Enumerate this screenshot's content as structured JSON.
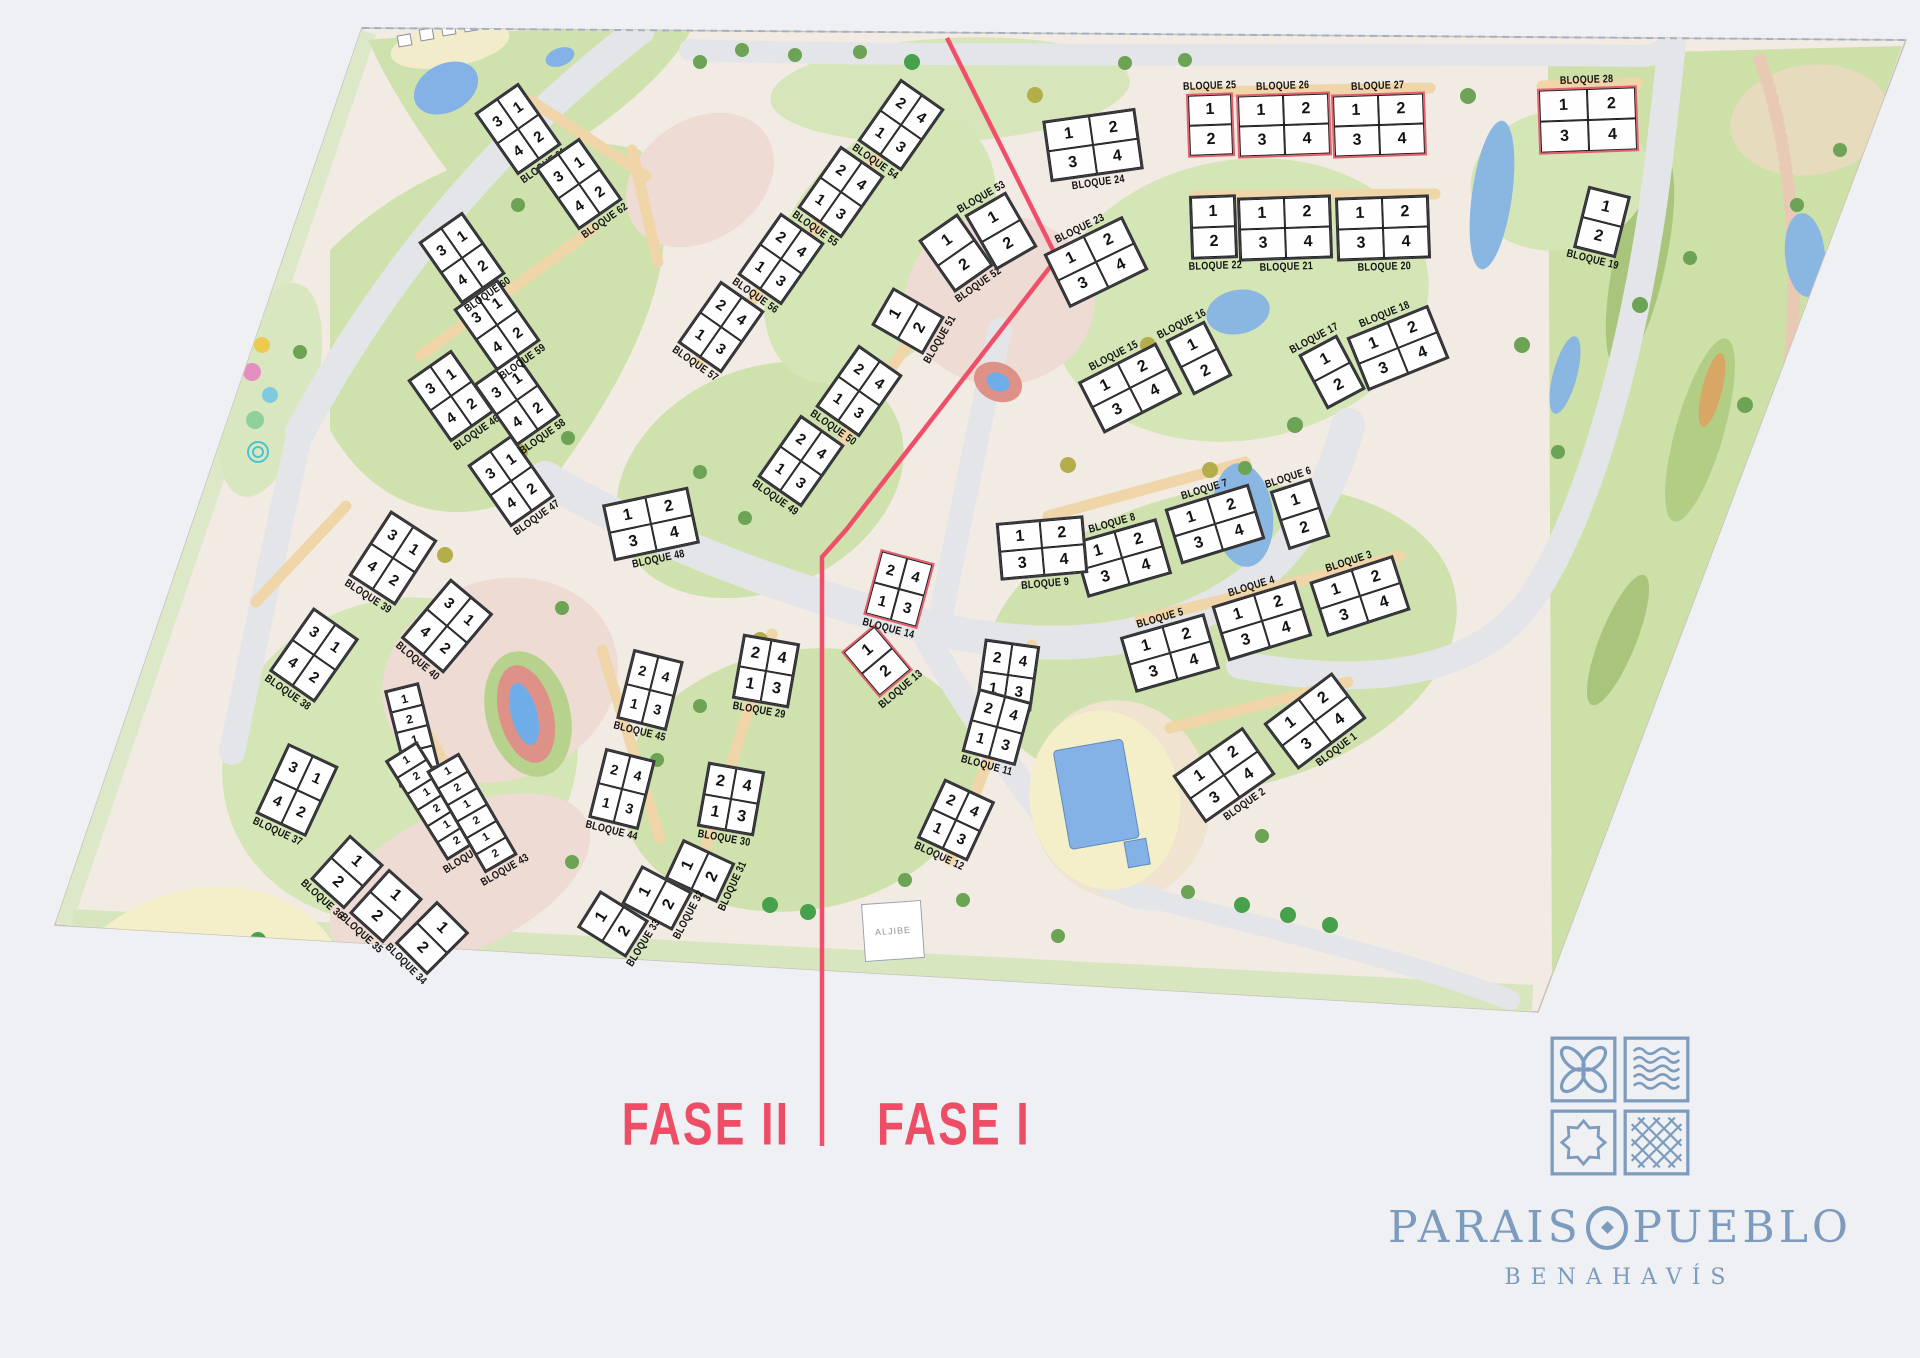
{
  "map": {
    "fase1_label": "FASE I",
    "fase2_label": "FASE II",
    "aljibe_label": "ALJIBE",
    "fase_line_points": "947,38 1057,258 846,530 822,557 822,1146",
    "colors": {
      "accent_red": "#ee4d66",
      "logo_blue": "#7d9cbd",
      "pool_blue": "#84b2e6",
      "lawn_green": "#cfe2ad",
      "road_gray": "#e4e5e9",
      "land_pink": "#f2ebe4",
      "block_white": "#fefefe"
    },
    "blocks": [
      {
        "id": 1,
        "label": "BLOQUE 1",
        "x": 1315,
        "y": 721,
        "w": 86,
        "h": 58,
        "a": -37,
        "cells": [
          [
            1,
            2
          ],
          [
            3,
            4
          ]
        ]
      },
      {
        "id": 2,
        "label": "BLOQUE 2",
        "x": 1224,
        "y": 775,
        "w": 86,
        "h": 58,
        "a": -35,
        "cells": [
          [
            1,
            2
          ],
          [
            3,
            4
          ]
        ]
      },
      {
        "id": 3,
        "label": "BLOQUE 3",
        "x": 1360,
        "y": 596,
        "w": 88,
        "h": 58,
        "a": -18,
        "cells": [
          [
            1,
            2
          ],
          [
            3,
            4
          ]
        ],
        "lp": "t"
      },
      {
        "id": 4,
        "label": "BLOQUE 4",
        "x": 1262,
        "y": 621,
        "w": 88,
        "h": 58,
        "a": -17,
        "cells": [
          [
            1,
            2
          ],
          [
            3,
            4
          ]
        ],
        "lp": "t"
      },
      {
        "id": 5,
        "label": "BLOQUE 5",
        "x": 1170,
        "y": 653,
        "w": 88,
        "h": 58,
        "a": -16,
        "cells": [
          [
            1,
            2
          ],
          [
            3,
            4
          ]
        ],
        "lp": "t"
      },
      {
        "id": 6,
        "label": "BLOQUE 6",
        "x": 1300,
        "y": 514,
        "w": 44,
        "h": 62,
        "a": -18,
        "cells": [
          [
            1
          ],
          [
            2
          ]
        ],
        "lp": "t"
      },
      {
        "id": 7,
        "label": "BLOQUE 7",
        "x": 1215,
        "y": 524,
        "w": 88,
        "h": 58,
        "a": -17,
        "cells": [
          [
            1,
            2
          ],
          [
            3,
            4
          ]
        ],
        "lp": "t"
      },
      {
        "id": 8,
        "label": "BLOQUE 8",
        "x": 1122,
        "y": 558,
        "w": 88,
        "h": 58,
        "a": -16,
        "cells": [
          [
            1,
            2
          ],
          [
            3,
            4
          ]
        ],
        "lp": "t"
      },
      {
        "id": 9,
        "label": "BLOQUE 9",
        "x": 1042,
        "y": 548,
        "w": 88,
        "h": 58,
        "a": -5,
        "cells": [
          [
            1,
            2
          ],
          [
            3,
            4
          ]
        ]
      },
      {
        "id": 10,
        "label": "BLOQUE 10",
        "x": 1008,
        "y": 675,
        "w": 56,
        "h": 66,
        "a": 8,
        "cells": [
          [
            2,
            4
          ],
          [
            1,
            3
          ]
        ]
      },
      {
        "id": 11,
        "label": "BLOQUE 11",
        "x": 997,
        "y": 727,
        "w": 56,
        "h": 66,
        "a": 15,
        "cells": [
          [
            2,
            4
          ],
          [
            1,
            3
          ]
        ]
      },
      {
        "id": 12,
        "label": "BLOQUE 12",
        "x": 956,
        "y": 820,
        "w": 56,
        "h": 66,
        "a": 25,
        "cells": [
          [
            2,
            4
          ],
          [
            1,
            3
          ]
        ]
      },
      {
        "id": 13,
        "label": "BLOQUE 13",
        "x": 877,
        "y": 661,
        "w": 44,
        "h": 60,
        "a": -40,
        "cells": [
          [
            1
          ],
          [
            2
          ]
        ],
        "hl": true
      },
      {
        "id": 14,
        "label": "BLOQUE 14",
        "x": 899,
        "y": 589,
        "w": 56,
        "h": 68,
        "a": 15,
        "cells": [
          [
            2,
            4
          ],
          [
            1,
            3
          ]
        ],
        "hl": true
      },
      {
        "id": 15,
        "label": "BLOQUE 15",
        "x": 1130,
        "y": 388,
        "w": 88,
        "h": 58,
        "a": -27,
        "cells": [
          [
            1,
            2
          ],
          [
            3,
            4
          ]
        ],
        "lp": "t"
      },
      {
        "id": 16,
        "label": "BLOQUE 16",
        "x": 1199,
        "y": 358,
        "w": 44,
        "h": 62,
        "a": -27,
        "cells": [
          [
            1
          ],
          [
            2
          ]
        ],
        "lp": "t"
      },
      {
        "id": 17,
        "label": "BLOQUE 17",
        "x": 1332,
        "y": 372,
        "w": 44,
        "h": 62,
        "a": -28,
        "cells": [
          [
            1
          ],
          [
            2
          ]
        ],
        "lp": "t"
      },
      {
        "id": 18,
        "label": "BLOQUE 18",
        "x": 1398,
        "y": 348,
        "w": 88,
        "h": 58,
        "a": -22,
        "cells": [
          [
            1,
            2
          ],
          [
            3,
            4
          ]
        ],
        "lp": "t"
      },
      {
        "id": 19,
        "label": "BLOQUE 19",
        "x": 1602,
        "y": 222,
        "w": 44,
        "h": 64,
        "a": 14,
        "cells": [
          [
            1
          ],
          [
            2
          ]
        ]
      },
      {
        "id": 20,
        "label": "BLOQUE 20",
        "x": 1383,
        "y": 228,
        "w": 94,
        "h": 64,
        "a": -2,
        "cells": [
          [
            1,
            2
          ],
          [
            3,
            4
          ]
        ]
      },
      {
        "id": 21,
        "label": "BLOQUE 21",
        "x": 1285,
        "y": 228,
        "w": 94,
        "h": 64,
        "a": -2,
        "cells": [
          [
            1,
            2
          ],
          [
            3,
            4
          ]
        ]
      },
      {
        "id": 22,
        "label": "BLOQUE 22",
        "x": 1213,
        "y": 227,
        "w": 47,
        "h": 64,
        "a": -2,
        "cells": [
          [
            1
          ],
          [
            2
          ]
        ]
      },
      {
        "id": 23,
        "label": "BLOQUE 23",
        "x": 1096,
        "y": 262,
        "w": 88,
        "h": 60,
        "a": -26,
        "cells": [
          [
            1,
            2
          ],
          [
            3,
            4
          ]
        ],
        "lp": "t"
      },
      {
        "id": 24,
        "label": "BLOQUE 24",
        "x": 1093,
        "y": 145,
        "w": 94,
        "h": 62,
        "a": -8,
        "cells": [
          [
            1,
            2
          ],
          [
            3,
            4
          ]
        ]
      },
      {
        "id": 25,
        "label": "BLOQUE 25",
        "x": 1210,
        "y": 125,
        "w": 47,
        "h": 64,
        "a": -2,
        "cells": [
          [
            1
          ],
          [
            2
          ]
        ],
        "hl": true,
        "lp": "t"
      },
      {
        "id": 26,
        "label": "BLOQUE 26",
        "x": 1284,
        "y": 125,
        "w": 94,
        "h": 64,
        "a": -2,
        "cells": [
          [
            1,
            2
          ],
          [
            3,
            4
          ]
        ],
        "hl": true,
        "lp": "t"
      },
      {
        "id": 27,
        "label": "BLOQUE 27",
        "x": 1379,
        "y": 125,
        "w": 94,
        "h": 64,
        "a": -2,
        "cells": [
          [
            1,
            2
          ],
          [
            3,
            4
          ]
        ],
        "hl": true,
        "lp": "t"
      },
      {
        "id": 28,
        "label": "BLOQUE 28",
        "x": 1588,
        "y": 120,
        "w": 100,
        "h": 66,
        "a": -2,
        "cells": [
          [
            1,
            2
          ],
          [
            3,
            4
          ]
        ],
        "hl": true,
        "lp": "t"
      },
      {
        "id": 29,
        "label": "BLOQUE 29",
        "x": 766,
        "y": 671,
        "w": 58,
        "h": 66,
        "a": 10,
        "cells": [
          [
            2,
            4
          ],
          [
            1,
            3
          ]
        ]
      },
      {
        "id": 30,
        "label": "BLOQUE 30",
        "x": 731,
        "y": 799,
        "w": 58,
        "h": 66,
        "a": 10,
        "cells": [
          [
            2,
            4
          ],
          [
            1,
            3
          ]
        ]
      },
      {
        "id": 31,
        "label": "BLOQUE 31",
        "x": 700,
        "y": 871,
        "w": 44,
        "h": 58,
        "a": -65,
        "cells": [
          [
            1
          ],
          [
            2
          ]
        ]
      },
      {
        "id": 32,
        "label": "BLOQUE 32",
        "x": 657,
        "y": 898,
        "w": 44,
        "h": 58,
        "a": -62,
        "cells": [
          [
            1
          ],
          [
            2
          ]
        ]
      },
      {
        "id": 33,
        "label": "BLOQUE 33",
        "x": 613,
        "y": 924,
        "w": 44,
        "h": 58,
        "a": -58,
        "cells": [
          [
            1
          ],
          [
            2
          ]
        ]
      },
      {
        "id": 34,
        "label": "BLOQUE 34",
        "x": 432,
        "y": 938,
        "w": 46,
        "h": 60,
        "a": 45,
        "cells": [
          [
            1
          ],
          [
            2
          ]
        ]
      },
      {
        "id": 35,
        "label": "BLOQUE 35",
        "x": 386,
        "y": 906,
        "w": 46,
        "h": 60,
        "a": 42,
        "cells": [
          [
            1
          ],
          [
            2
          ]
        ]
      },
      {
        "id": 36,
        "label": "BLOQUE 36",
        "x": 347,
        "y": 872,
        "w": 46,
        "h": 60,
        "a": 42,
        "cells": [
          [
            1
          ],
          [
            2
          ]
        ]
      },
      {
        "id": 37,
        "label": "BLOQUE 37",
        "x": 297,
        "y": 790,
        "w": 56,
        "h": 78,
        "a": 25,
        "cells": [
          [
            3,
            1
          ],
          [
            4,
            2
          ]
        ]
      },
      {
        "id": 38,
        "label": "BLOQUE 38",
        "x": 314,
        "y": 655,
        "w": 56,
        "h": 78,
        "a": 35,
        "cells": [
          [
            3,
            1
          ],
          [
            4,
            2
          ]
        ]
      },
      {
        "id": 39,
        "label": "BLOQUE 39",
        "x": 393,
        "y": 558,
        "w": 56,
        "h": 78,
        "a": 33,
        "cells": [
          [
            3,
            1
          ],
          [
            4,
            2
          ]
        ]
      },
      {
        "id": 40,
        "label": "BLOQUE 40",
        "x": 447,
        "y": 626,
        "w": 56,
        "h": 78,
        "a": 40,
        "cells": [
          [
            3,
            1
          ],
          [
            4,
            2
          ]
        ]
      },
      {
        "id": 41,
        "label": "BLOQUE 41",
        "x": 412,
        "y": 729,
        "w": 36,
        "h": 88,
        "a": -14,
        "cells": [
          [
            1
          ],
          [
            2
          ],
          [
            1
          ],
          [
            2
          ]
        ]
      },
      {
        "id": 42,
        "label": "BLOQUE 42",
        "x": 432,
        "y": 801,
        "w": 38,
        "h": 118,
        "a": -32,
        "cells": [
          [
            1
          ],
          [
            2
          ],
          [
            1
          ],
          [
            2
          ],
          [
            1
          ],
          [
            2
          ]
        ]
      },
      {
        "id": 43,
        "label": "BLOQUE 43",
        "x": 472,
        "y": 813,
        "w": 38,
        "h": 118,
        "a": -30,
        "cells": [
          [
            1
          ],
          [
            2
          ],
          [
            1
          ],
          [
            2
          ],
          [
            1
          ],
          [
            2
          ]
        ]
      },
      {
        "id": 44,
        "label": "BLOQUE 44",
        "x": 622,
        "y": 789,
        "w": 52,
        "h": 72,
        "a": 14,
        "cells": [
          [
            2,
            4
          ],
          [
            1,
            3
          ]
        ]
      },
      {
        "id": 45,
        "label": "BLOQUE 45",
        "x": 650,
        "y": 690,
        "w": 52,
        "h": 72,
        "a": 14,
        "cells": [
          [
            2,
            4
          ],
          [
            1,
            3
          ]
        ]
      },
      {
        "id": 46,
        "label": "BLOQUE 46",
        "x": 451,
        "y": 396,
        "w": 54,
        "h": 76,
        "a": -35,
        "cells": [
          [
            3,
            1
          ],
          [
            4,
            2
          ]
        ]
      },
      {
        "id": 47,
        "label": "BLOQUE 47",
        "x": 511,
        "y": 481,
        "w": 54,
        "h": 76,
        "a": -35,
        "cells": [
          [
            3,
            1
          ],
          [
            4,
            2
          ]
        ]
      },
      {
        "id": 48,
        "label": "BLOQUE 48",
        "x": 651,
        "y": 524,
        "w": 88,
        "h": 58,
        "a": -12,
        "cells": [
          [
            1,
            2
          ],
          [
            3,
            4
          ]
        ]
      },
      {
        "id": 49,
        "label": "BLOQUE 49",
        "x": 801,
        "y": 461,
        "w": 54,
        "h": 76,
        "a": 35,
        "cells": [
          [
            2,
            4
          ],
          [
            1,
            3
          ]
        ]
      },
      {
        "id": 50,
        "label": "BLOQUE 50",
        "x": 859,
        "y": 391,
        "w": 54,
        "h": 76,
        "a": 35,
        "cells": [
          [
            2,
            4
          ],
          [
            1,
            3
          ]
        ]
      },
      {
        "id": 51,
        "label": "BLOQUE 51",
        "x": 908,
        "y": 321,
        "w": 44,
        "h": 60,
        "a": -60,
        "cells": [
          [
            1
          ],
          [
            2
          ]
        ]
      },
      {
        "id": 52,
        "label": "BLOQUE 52",
        "x": 956,
        "y": 253,
        "w": 48,
        "h": 64,
        "a": -35,
        "cells": [
          [
            1
          ],
          [
            2
          ]
        ]
      },
      {
        "id": 53,
        "label": "BLOQUE 53",
        "x": 1001,
        "y": 231,
        "w": 48,
        "h": 64,
        "a": -30,
        "cells": [
          [
            1
          ],
          [
            2
          ]
        ],
        "lp": "t"
      },
      {
        "id": 54,
        "label": "BLOQUE 54",
        "x": 901,
        "y": 125,
        "w": 54,
        "h": 76,
        "a": 35,
        "cells": [
          [
            2,
            4
          ],
          [
            1,
            3
          ]
        ]
      },
      {
        "id": 55,
        "label": "BLOQUE 55",
        "x": 841,
        "y": 192,
        "w": 54,
        "h": 76,
        "a": 35,
        "cells": [
          [
            2,
            4
          ],
          [
            1,
            3
          ]
        ]
      },
      {
        "id": 56,
        "label": "BLOQUE 56",
        "x": 781,
        "y": 259,
        "w": 54,
        "h": 76,
        "a": 35,
        "cells": [
          [
            2,
            4
          ],
          [
            1,
            3
          ]
        ]
      },
      {
        "id": 57,
        "label": "BLOQUE 57",
        "x": 721,
        "y": 327,
        "w": 54,
        "h": 76,
        "a": 35,
        "cells": [
          [
            2,
            4
          ],
          [
            1,
            3
          ]
        ]
      },
      {
        "id": 58,
        "label": "BLOQUE 58",
        "x": 517,
        "y": 400,
        "w": 54,
        "h": 76,
        "a": -35,
        "cells": [
          [
            3,
            1
          ],
          [
            4,
            2
          ]
        ]
      },
      {
        "id": 59,
        "label": "BLOQUE 59",
        "x": 497,
        "y": 325,
        "w": 54,
        "h": 76,
        "a": -35,
        "cells": [
          [
            3,
            1
          ],
          [
            4,
            2
          ]
        ]
      },
      {
        "id": 60,
        "label": "BLOQUE 60",
        "x": 462,
        "y": 258,
        "w": 54,
        "h": 76,
        "a": -35,
        "cells": [
          [
            3,
            1
          ],
          [
            4,
            2
          ]
        ]
      },
      {
        "id": 61,
        "label": "BLOQUE 61",
        "x": 518,
        "y": 129,
        "w": 54,
        "h": 76,
        "a": -35,
        "cells": [
          [
            3,
            1
          ],
          [
            4,
            2
          ]
        ]
      },
      {
        "id": 62,
        "label": "BLOQUE 62",
        "x": 579,
        "y": 184,
        "w": 54,
        "h": 76,
        "a": -35,
        "cells": [
          [
            3,
            1
          ],
          [
            4,
            2
          ]
        ]
      }
    ]
  },
  "brand": {
    "name": "PARAISOPUEBLO",
    "name_left": "PARAIS",
    "name_right": "PUEBLO",
    "subtitle": "BENAHAVÍS"
  }
}
